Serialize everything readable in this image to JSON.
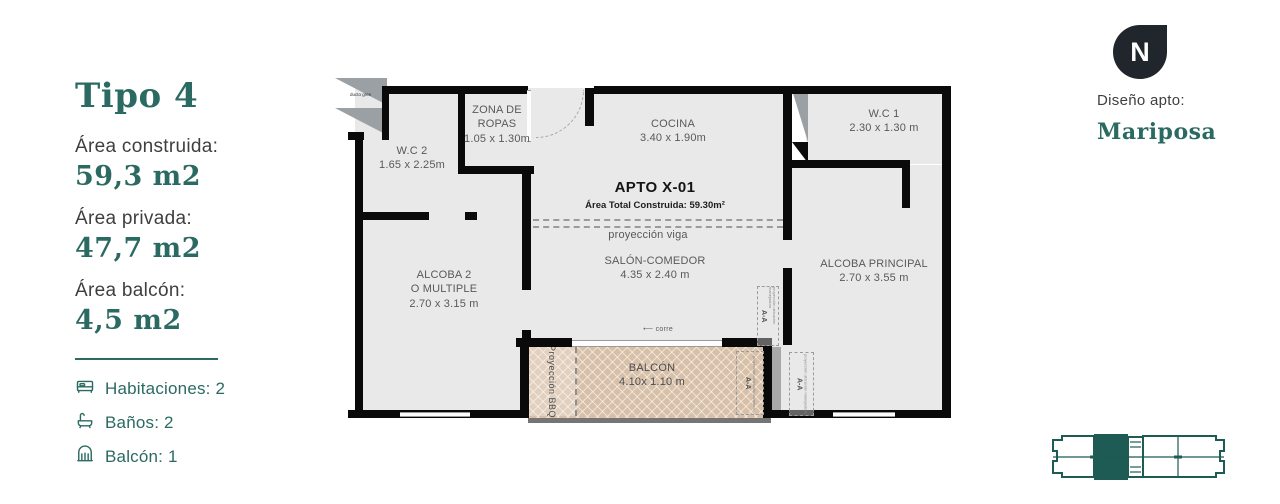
{
  "accent": "#2b6a62",
  "panel": {
    "title": "Tipo 4",
    "areas": [
      {
        "label": "Área construida:",
        "value": "59,3 m2"
      },
      {
        "label": "Área privada:",
        "value": "47,7 m2"
      },
      {
        "label": "Área balcón:",
        "value": "4,5 m2"
      }
    ],
    "features": [
      {
        "icon": "bed-icon",
        "label": "Habitaciones: 2"
      },
      {
        "icon": "bath-icon",
        "label": "Baños: 2"
      },
      {
        "icon": "balcony-icon",
        "label": "Balcón: 1"
      }
    ]
  },
  "plan": {
    "apto": {
      "title": "APTO X-01",
      "subtitle": "Área Total Construida: 59.30m²"
    },
    "labels": {
      "viga": "proyección viga",
      "corre_arrow": "⟵",
      "corre": "corre",
      "ducto": "ducto gres",
      "bbq": "Proyección BBQ",
      "aa": "A-A",
      "aa_sub_manejadora": "proyección ubicación manejadora",
      "aa_sub_lavadero": "proyección ubicación lavadero"
    },
    "rooms": {
      "wc2": {
        "name": "W.C 2",
        "dims": "1.65 x 2.25m"
      },
      "zona": {
        "name1": "ZONA DE",
        "name2": "ROPAS",
        "dims": "1.05 x 1.30m"
      },
      "cocina": {
        "name": "COCINA",
        "dims": "3.40 x 1.90m"
      },
      "wc1": {
        "name": "W.C 1",
        "dims": "2.30 x 1.30 m"
      },
      "salon": {
        "name": "SALÓN-COMEDOR",
        "dims": "4.35 x 2.40 m"
      },
      "alcoba2": {
        "name1": "ALCOBA 2",
        "name2": "O MULTIPLE",
        "dims": "2.70 x 3.15 m"
      },
      "principal": {
        "name": "ALCOBA PRINCIPAL",
        "dims": "2.70 x 3.55 m"
      },
      "balcon": {
        "name": "BALCÓN",
        "dims": "4.10x 1.10 m"
      }
    }
  },
  "compass": {
    "letter": "N"
  },
  "design": {
    "label": "Diseño apto:",
    "value": "Mariposa"
  }
}
